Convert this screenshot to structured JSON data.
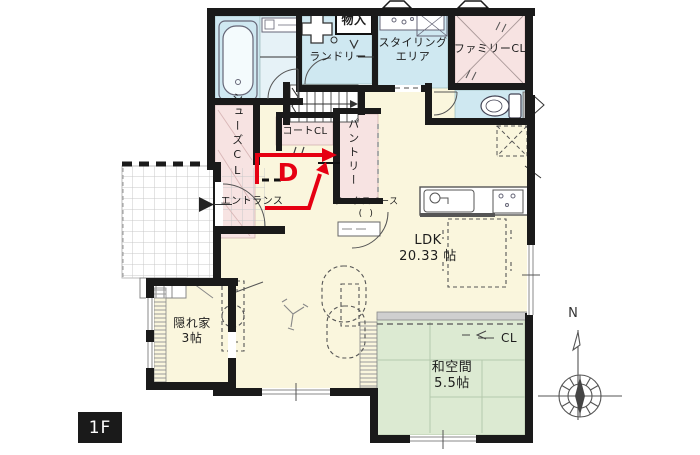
{
  "title": "1F間取り図",
  "floor_badge": "1F",
  "compass": {
    "north": "N"
  },
  "route": {
    "marker": "D"
  },
  "labels": {
    "monoire": "物入",
    "laundry": "ランドリー",
    "styling_line1": "スタイリング",
    "styling_line2": "エリア",
    "family_cl": "ファミリーCL",
    "shoes_cl": "シューズCL",
    "coat_cl": "コートCL",
    "pantry": "パントリー",
    "entrance": "エントランス",
    "workspace": "ワークスペース",
    "workspace_note": "(  )",
    "ldk_name": "LDK",
    "ldk_size": "20.33 帖",
    "kakurega_name": "隠れ家",
    "kakurega_size": "3帖",
    "washitsu_name": "和空間",
    "washitsu_size": "5.5帖",
    "cl": "CL"
  },
  "colors": {
    "wall": "#1a1a1a",
    "floor_cream": "#faf6dd",
    "room_blue": "#cfe8f1",
    "closet_pink": "#f7e3e2",
    "tatami_green": "#dcead2",
    "route_red": "#e60012"
  }
}
